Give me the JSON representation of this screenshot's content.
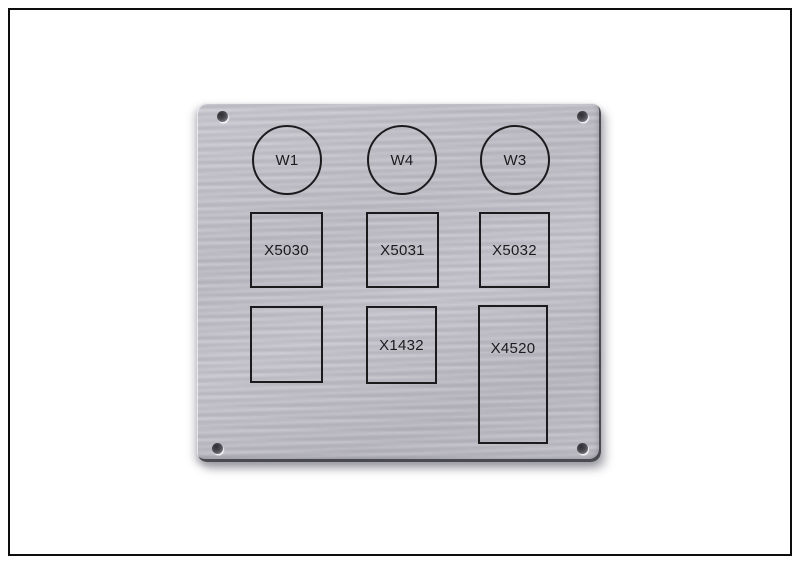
{
  "colors": {
    "background": "#ffffff",
    "frame_border": "#0d0d0d",
    "plate_metal": "#c1c0c8",
    "engraving": "#1b1b1e"
  },
  "plate": {
    "description": "brushed aluminum engraved label plate",
    "circles": [
      {
        "label": "W1"
      },
      {
        "label": "W4"
      },
      {
        "label": "W3"
      }
    ],
    "row1": [
      {
        "label": "X5030"
      },
      {
        "label": "X5031"
      },
      {
        "label": "X5032"
      }
    ],
    "row2": [
      {
        "label": ""
      },
      {
        "label": "X1432"
      },
      {
        "label": "X4520"
      }
    ]
  }
}
